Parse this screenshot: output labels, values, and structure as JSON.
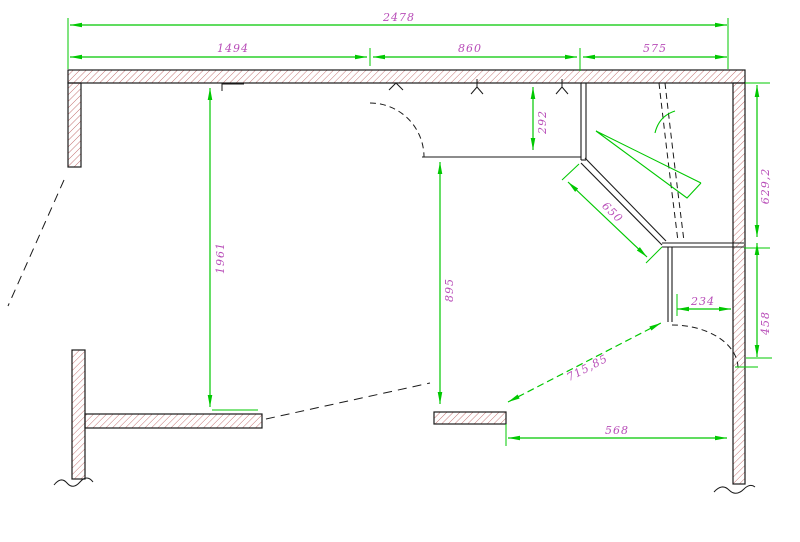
{
  "drawing": {
    "type": "cad-floor-plan",
    "units_note": "",
    "colors": {
      "dimension_green": "#00c800",
      "dimension_text_magenta": "#b84db8",
      "wall_hatch_red": "#c06868",
      "outline_black": "#1a1a1a",
      "background": "#ffffff"
    },
    "dimensions": {
      "top_total": "2478",
      "top_left": "1494",
      "top_middle": "860",
      "top_right": "575",
      "left_room_height": "1961",
      "opening_height": "292",
      "counter_run_height": "895",
      "right_upper_height": "629,2",
      "diagonal_wall": "650",
      "niche_width": "234",
      "niche_height": "458",
      "diagonal_clearance": "715,85",
      "bottom_width": "568"
    }
  }
}
